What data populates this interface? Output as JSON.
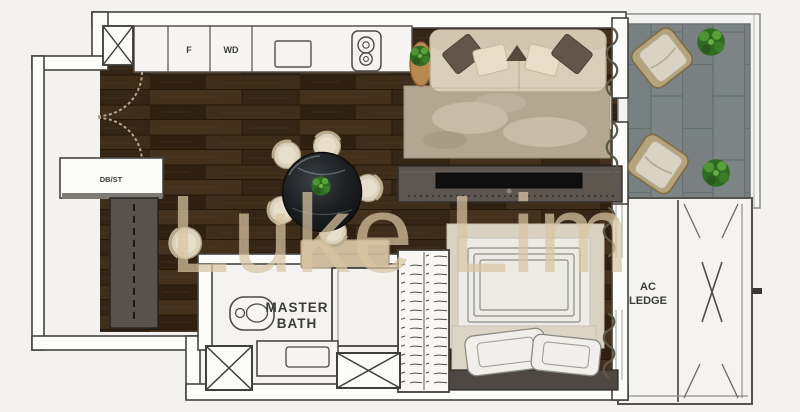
{
  "watermark": {
    "text": "Luke Lim"
  },
  "labels": {
    "fridge": "F",
    "washer_dryer": "WD",
    "db_storage": "DB/ST",
    "master_bath_line1": "MASTER",
    "master_bath_line2": "BATH",
    "ac_ledge_line1": "AC",
    "ac_ledge_line2": "LEDGE"
  },
  "colors": {
    "background": "#f3f2ef",
    "wall_stroke": "#45433f",
    "wall_fill": "#fbfbf9",
    "wood_base": "#3a2a1b",
    "tile_base": "#7b8182",
    "furniture_beige": "#d8ceb9",
    "console_grey": "#5d5550",
    "marble_black": "#1d2023",
    "plant_green": "#3f7d2c",
    "curtain": "#5a594a",
    "label_text": "#3b3b39",
    "watermark": "rgba(216,197,161,0.72)"
  }
}
